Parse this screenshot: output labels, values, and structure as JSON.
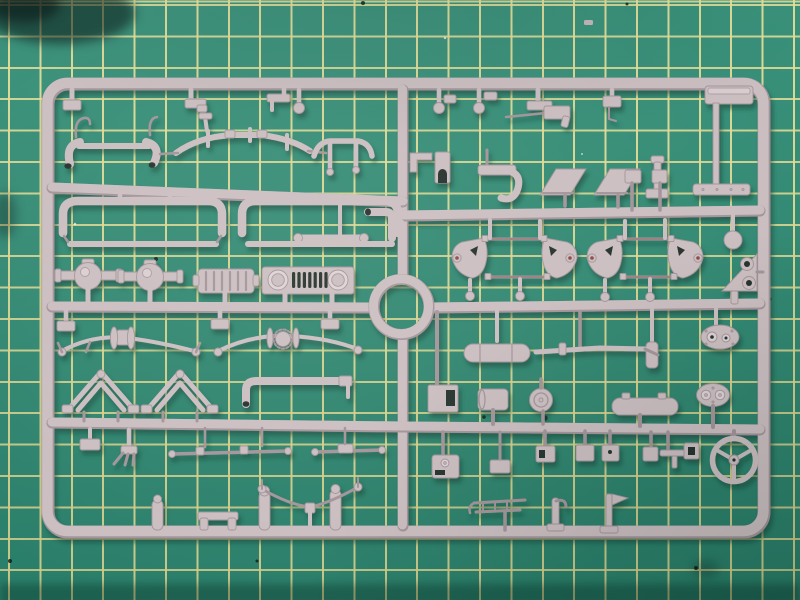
{
  "scene": {
    "description": "Top-down photograph of a light pink-grey injection moulded model kit sprue (runner frame full of small vehicle parts) lying on a green self-healing cutting mat with pale yellow grid lines",
    "objects": [
      "cutting-mat",
      "plastic-sprue-with-parts"
    ],
    "visible_text": ""
  },
  "palette": {
    "mat_green": "#2e8b74",
    "mat_green_dark": "#1d6e5b",
    "grid_yellow": "#e4de96",
    "plastic": "#cbbec1",
    "plastic_highlight": "#ded2d5",
    "plastic_shadow": "#a3949a",
    "mold_red": "#8e4a42",
    "hole_dark": "#27332e",
    "cast_shadow": "#0c3a2e"
  },
  "mat": {
    "grid_spacing_px": 31.4,
    "grid_line_px": 2,
    "grid_offset_x_px": 9,
    "grid_offset_y_px": 5,
    "dark_stain_top_left": true
  },
  "sprue": {
    "frame": {
      "left": 48,
      "top": 84,
      "right": 764,
      "bottom": 532,
      "corner_radius": 20,
      "rail_width_px": 13
    },
    "center_runner_x": 403,
    "runner_rows_y": [
      195,
      214,
      307,
      427
    ],
    "ring_part": {
      "x": 401,
      "y": 307,
      "outer_radius": 32
    },
    "mold_tag": {
      "x": 705,
      "y": 86,
      "width": 48,
      "height": 18
    },
    "parts": [
      {
        "name": "stub-block",
        "area": "top-left-rail"
      },
      {
        "name": "stub-foot",
        "area": "top-rail"
      },
      {
        "name": "angle-bracket",
        "area": "top-rail"
      },
      {
        "name": "ball-pin-x3",
        "area": "top-rail"
      },
      {
        "name": "foot-bracket",
        "area": "top-right-rail"
      },
      {
        "name": "machine-gun",
        "area": "top-right"
      },
      {
        "name": "hook-block",
        "area": "top-right"
      },
      {
        "name": "front-bumper-tubes",
        "area": "row2-left"
      },
      {
        "name": "curved-sway-bar",
        "area": "row2-left"
      },
      {
        "name": "short-tube-bar",
        "area": "row2-left"
      },
      {
        "name": "elbow-pipe",
        "area": "center-top"
      },
      {
        "name": "round-end-bar",
        "area": "center-top"
      },
      {
        "name": "u-channel-bumper-x2",
        "area": "row3-left"
      },
      {
        "name": "axle-housing-x2",
        "area": "row4-left"
      },
      {
        "name": "slatted-intercooler",
        "area": "row4-left"
      },
      {
        "name": "jeep-grille-with-headlights",
        "area": "row4-left"
      },
      {
        "name": "spare-ring",
        "area": "center"
      },
      {
        "name": "front-axle-leafspring-x2",
        "area": "row5-left"
      },
      {
        "name": "a-frame-windshield-x2",
        "area": "row6-left"
      },
      {
        "name": "l-pipe",
        "area": "row6-left"
      },
      {
        "name": "claw-manifold",
        "area": "row7-left"
      },
      {
        "name": "tie-rod-x2",
        "area": "row7-left"
      },
      {
        "name": "shock-cylinder-x3",
        "area": "bottom-left"
      },
      {
        "name": "twin-foot-bracket",
        "area": "bottom-left"
      },
      {
        "name": "wishbone-linkage",
        "area": "bottom-left"
      },
      {
        "name": "runner-clip",
        "area": "center-column"
      },
      {
        "name": "arched-door-block",
        "area": "center-column"
      },
      {
        "name": "hook-hammer",
        "area": "top-right-half"
      },
      {
        "name": "bench-seat-x2",
        "area": "top-right-half"
      },
      {
        "name": "post-with-foot",
        "area": "top-right-half"
      },
      {
        "name": "running-board",
        "area": "right-edge"
      },
      {
        "name": "small-box-x2",
        "area": "right-half"
      },
      {
        "name": "chassis-frame-oval-x2-with-red-mould-marks",
        "area": "right-middle"
      },
      {
        "name": "disc-cap",
        "area": "right-middle"
      },
      {
        "name": "triangle-bracket-two-holes",
        "area": "right-rail"
      },
      {
        "name": "gearbox-cover",
        "area": "right-middle"
      },
      {
        "name": "muffler",
        "area": "right-middle"
      },
      {
        "name": "exhaust-pipe",
        "area": "right-middle"
      },
      {
        "name": "notched-box",
        "area": "right-middle"
      },
      {
        "name": "cylinder-can",
        "area": "right-middle"
      },
      {
        "name": "round-lid",
        "area": "right-middle"
      },
      {
        "name": "fuel-tank",
        "area": "right-middle"
      },
      {
        "name": "instrument-panel-two-gauges",
        "area": "right-middle"
      },
      {
        "name": "small-boxes-row-x5",
        "area": "bottom-right"
      },
      {
        "name": "steering-wheel-three-spokes",
        "area": "bottom-right"
      },
      {
        "name": "fender-bracket",
        "area": "bottom-center"
      },
      {
        "name": "tool-rack",
        "area": "bottom-right"
      },
      {
        "name": "hooked-post",
        "area": "bottom-right"
      },
      {
        "name": "flag-post",
        "area": "bottom-right"
      }
    ]
  }
}
